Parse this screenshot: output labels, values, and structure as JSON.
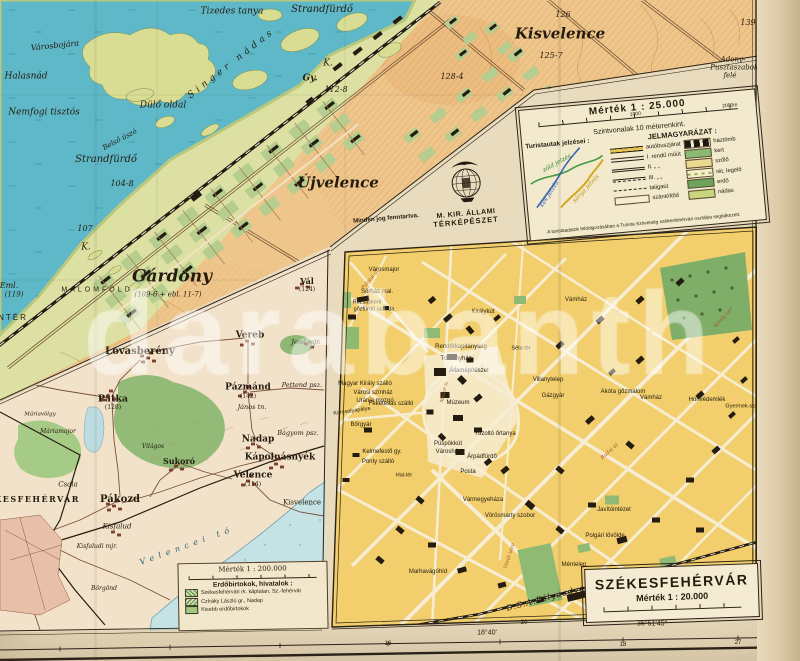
{
  "legend25": {
    "title": "Mérték 1 : 25.000",
    "scale_left": "1000",
    "scale_right": "2000m",
    "contours": "Szintvonalak 10 méterenkint.",
    "tourist_heading": "Turistautak jelzései :",
    "tourist_labels": [
      {
        "t": "zöld jelzés",
        "x": 30,
        "y": 16,
        "fs": 6,
        "st": "si",
        "rot": -24,
        "c": "#2e8b3a"
      },
      {
        "t": "kék jelzés",
        "x": 20,
        "y": 46,
        "fs": 6,
        "st": "si",
        "rot": -52,
        "c": "#2b5fae"
      },
      {
        "t": "sárga jelzés",
        "x": 57,
        "y": 44,
        "fs": 6,
        "st": "si",
        "rot": -42,
        "c": "#b8931c"
      }
    ],
    "key_heading": "JELMAGYARÁZAT :",
    "routes": [
      {
        "label": "autóbuszjárat",
        "swatch": "bus"
      },
      {
        "label": "I. rendű műút",
        "swatch": "road1"
      },
      {
        "label": "II.  „    „",
        "swatch": "road2"
      },
      {
        "label": "III.  „    „",
        "swatch": "road3"
      },
      {
        "label": "taligaút",
        "swatch": "cart"
      },
      {
        "label": "szántóföld",
        "swatch": "field"
      }
    ],
    "areas": [
      {
        "label": "háztömb",
        "swatch": "block"
      },
      {
        "label": "kert",
        "swatch": "garden"
      },
      {
        "label": "szőlő",
        "swatch": "vineyard"
      },
      {
        "label": "rét, legelő",
        "swatch": "meadow"
      },
      {
        "label": "erdő",
        "swatch": "forest"
      },
      {
        "label": "nádas",
        "swatch": "reed"
      }
    ],
    "rights": "Minden jog fenntartva.",
    "logo_line1": "M. KIR. ÁLLAMI",
    "logo_line2": "TÉRKÉPÉSZET",
    "credit": "A turistaadatok feldolgozásában a Turista Szövetség székesfehérvári osztálya segédkezett."
  },
  "title20": {
    "title": "SZÉKESFEHÉRVÁR",
    "scale": "Mérték 1 : 20.000"
  },
  "legend200": {
    "scale": "Mérték 1 : 200.000",
    "heading": "Erdőbirtokok, hivatalok :",
    "items": [
      {
        "label": "Székesfehérvári rk. káptalan, Sz.-fehérvár",
        "swatch": "hatch1"
      },
      {
        "label": "Czíráky László gr., Nadap",
        "swatch": "hatch2"
      },
      {
        "label": "Kisebb erdőbirtokok",
        "swatch": "green"
      }
    ]
  },
  "watermark": {
    "text": "darabanth"
  },
  "lake_map": {
    "labels": [
      {
        "t": "Városbojára",
        "x": 55,
        "y": 46,
        "fs": 8,
        "st": "si",
        "rot": -6
      },
      {
        "t": "Halasnád",
        "x": 26,
        "y": 77,
        "fs": 9,
        "st": "si"
      },
      {
        "t": "Nemfogi tisztós",
        "x": 44,
        "y": 113,
        "fs": 9,
        "st": "si"
      },
      {
        "t": "Tizedes tanya",
        "x": 232,
        "y": 12,
        "fs": 9,
        "st": "si"
      },
      {
        "t": "Strandfürdő",
        "x": 322,
        "y": 10,
        "fs": 10,
        "st": "si"
      },
      {
        "t": "Strandfürdő",
        "x": 106,
        "y": 160,
        "fs": 10,
        "st": "si"
      },
      {
        "t": "Singer nádas",
        "x": 232,
        "y": 64,
        "fs": 9,
        "st": "si",
        "rot": -38,
        "ls": 4
      },
      {
        "t": "Dülő oldal",
        "x": 163,
        "y": 106,
        "fs": 9,
        "st": "si"
      },
      {
        "t": "Belső úszó",
        "x": 120,
        "y": 140,
        "fs": 7,
        "st": "si",
        "rot": -28
      },
      {
        "t": "Újvelence",
        "x": 338,
        "y": 183,
        "fs": 15,
        "st": "sbi"
      },
      {
        "t": "Kisvelence",
        "x": 560,
        "y": 34,
        "fs": 15,
        "st": "sbi"
      },
      {
        "t": "126",
        "x": 563,
        "y": 15,
        "fs": 8,
        "st": "si"
      },
      {
        "t": "125-7",
        "x": 551,
        "y": 56,
        "fs": 8,
        "st": "si"
      },
      {
        "t": "128-4",
        "x": 452,
        "y": 77,
        "fs": 8,
        "st": "si"
      },
      {
        "t": "112-8",
        "x": 336,
        "y": 90,
        "fs": 8,
        "st": "si"
      },
      {
        "t": "Gy.",
        "x": 310,
        "y": 79,
        "fs": 9,
        "st": "sbi"
      },
      {
        "t": "K.",
        "x": 328,
        "y": 64,
        "fs": 9,
        "st": "si"
      },
      {
        "t": "K.",
        "x": 86,
        "y": 248,
        "fs": 9,
        "st": "si"
      },
      {
        "t": "107",
        "x": 85,
        "y": 229,
        "fs": 8,
        "st": "si"
      },
      {
        "t": "104-8",
        "x": 122,
        "y": 184,
        "fs": 8,
        "st": "si"
      },
      {
        "t": "Gárdony",
        "x": 172,
        "y": 277,
        "fs": 17,
        "st": "sbi"
      },
      {
        "t": "(109-6 + ebl. 11-7)",
        "x": 168,
        "y": 295,
        "fs": 7,
        "st": "si"
      },
      {
        "t": "MALOMFÖLD",
        "x": 97,
        "y": 290,
        "fs": 7,
        "st": "s",
        "ls": 3
      },
      {
        "t": "Adony-",
        "x": 733,
        "y": 60,
        "fs": 7,
        "st": "si"
      },
      {
        "t": "Pusztaszabolcs",
        "x": 737,
        "y": 68,
        "fs": 7,
        "st": "si"
      },
      {
        "t": "felé",
        "x": 730,
        "y": 76,
        "fs": 7,
        "st": "si"
      },
      {
        "t": "NTÉR",
        "x": 13,
        "y": 318,
        "fs": 8,
        "st": "s",
        "ls": 2
      },
      {
        "t": "Eml.",
        "x": 9,
        "y": 286,
        "fs": 8,
        "st": "si"
      },
      {
        "t": "(119)",
        "x": 14,
        "y": 295,
        "fs": 7,
        "st": "si"
      },
      {
        "t": "139",
        "x": 748,
        "y": 23,
        "fs": 8,
        "st": "si"
      }
    ]
  },
  "city_map": {
    "labels": [
      {
        "t": "Városmajor",
        "x": 384,
        "y": 270
      },
      {
        "t": "Sörház mal.",
        "x": 377,
        "y": 292
      },
      {
        "t": "Rózsáskerti",
        "x": 367,
        "y": 303,
        "fs": 5.5
      },
      {
        "t": "gőzfürdő uszoda",
        "x": 374,
        "y": 310,
        "fs": 5.5
      },
      {
        "t": "Királykút",
        "x": 483,
        "y": 312
      },
      {
        "t": "Rendőrkapitányság",
        "x": 461,
        "y": 347
      },
      {
        "t": "Törvényház",
        "x": 456,
        "y": 359
      },
      {
        "t": "Államépítészet",
        "x": 469,
        "y": 371
      },
      {
        "t": "Magyar Király szálló",
        "x": 365,
        "y": 384
      },
      {
        "t": "Városi színház",
        "x": 373,
        "y": 393
      },
      {
        "t": "Uránia mozgó",
        "x": 375,
        "y": 401
      },
      {
        "t": "Feketesas szálló",
        "x": 391,
        "y": 404
      },
      {
        "t": "Múzeum",
        "x": 458,
        "y": 403
      },
      {
        "t": "Bőrgyár",
        "x": 361,
        "y": 425
      },
      {
        "t": "Korcsolyapálya",
        "x": 352,
        "y": 412,
        "fs": 5.5,
        "rot": -8
      },
      {
        "t": "Kelmefestő gy.",
        "x": 382,
        "y": 452
      },
      {
        "t": "Ponty szálló",
        "x": 378,
        "y": 462
      },
      {
        "t": "Püspökkút",
        "x": 448,
        "y": 444
      },
      {
        "t": "Városháza",
        "x": 450,
        "y": 452
      },
      {
        "t": "Árpádfürdő",
        "x": 482,
        "y": 457
      },
      {
        "t": "Tűzoltó őrtanya",
        "x": 495,
        "y": 434
      },
      {
        "t": "Posta",
        "x": 468,
        "y": 472
      },
      {
        "t": "Hal-tér",
        "x": 404,
        "y": 476,
        "fs": 5.5
      },
      {
        "t": "Vármegyeháza",
        "x": 483,
        "y": 500
      },
      {
        "t": "Vörösmarty szobor",
        "x": 510,
        "y": 516
      },
      {
        "t": "Séta tér",
        "x": 521,
        "y": 349,
        "fs": 5.5
      },
      {
        "t": "Vámház",
        "x": 576,
        "y": 300
      },
      {
        "t": "Vámház",
        "x": 651,
        "y": 398
      },
      {
        "t": "Akóta gőzmalom",
        "x": 623,
        "y": 392
      },
      {
        "t": "Honvédemlék",
        "x": 707,
        "y": 400
      },
      {
        "t": "Gyermek-szan.",
        "x": 744,
        "y": 407,
        "fs": 5.5
      },
      {
        "t": "Villanytelep",
        "x": 548,
        "y": 380
      },
      {
        "t": "Gázgyár",
        "x": 553,
        "y": 396
      },
      {
        "t": "Javítóintézet",
        "x": 614,
        "y": 510
      },
      {
        "t": "Polgári lövölde",
        "x": 605,
        "y": 536
      },
      {
        "t": "Méntelep",
        "x": 574,
        "y": 565
      },
      {
        "t": "Marhavágóhíd",
        "x": 428,
        "y": 572
      },
      {
        "t": "D.S.A.Pályaudvar",
        "x": 548,
        "y": 598,
        "st": "si",
        "fs": 8,
        "rot": -15,
        "ls": 1
      },
      {
        "t": "Felekola",
        "x": 598,
        "y": 612,
        "fs": 5.5
      },
      {
        "t": "Palotai út",
        "x": 371,
        "y": 280,
        "st": "si",
        "fs": 5,
        "rot": -50,
        "c": "#a5502c"
      },
      {
        "t": "Budai út",
        "x": 610,
        "y": 452,
        "st": "si",
        "fs": 5,
        "rot": -42,
        "c": "#a5502c"
      },
      {
        "t": "Király sor",
        "x": 724,
        "y": 318,
        "st": "si",
        "fs": 5,
        "rot": -48,
        "c": "#a5502c"
      },
      {
        "t": "Vasút utca",
        "x": 510,
        "y": 556,
        "st": "si",
        "fs": 5,
        "rot": -72,
        "c": "#a5502c"
      },
      {
        "t": "Nádor u.",
        "x": 445,
        "y": 392,
        "st": "si",
        "fs": 5,
        "rot": -78,
        "c": "#a5502c"
      }
    ]
  },
  "overview_map": {
    "labels": [
      {
        "t": "Lovasberény",
        "x": 140,
        "y": 352,
        "st": "srb",
        "fs": 10
      },
      {
        "t": "Vereb",
        "x": 250,
        "y": 336,
        "st": "srb",
        "fs": 9
      },
      {
        "t": "Pázmánd",
        "x": 248,
        "y": 388,
        "st": "srb",
        "fs": 9
      },
      {
        "t": "(142)",
        "x": 248,
        "y": 397,
        "st": "sr",
        "fs": 6
      },
      {
        "t": "János tn.",
        "x": 252,
        "y": 407,
        "st": "si",
        "fs": 6.5
      },
      {
        "t": "Pettend psz.",
        "x": 302,
        "y": 385,
        "st": "si",
        "fs": 6.5
      },
      {
        "t": "Bágyom psz.",
        "x": 298,
        "y": 433,
        "st": "si",
        "fs": 6.5
      },
      {
        "t": "Nadap",
        "x": 258,
        "y": 440,
        "st": "srb",
        "fs": 9
      },
      {
        "t": "Kápolnásnyék",
        "x": 280,
        "y": 458,
        "st": "srb",
        "fs": 9
      },
      {
        "t": "Velence",
        "x": 253,
        "y": 476,
        "st": "srb",
        "fs": 9
      },
      {
        "t": "(114)",
        "x": 253,
        "y": 485,
        "st": "sr",
        "fs": 6
      },
      {
        "t": "Kisvelence",
        "x": 302,
        "y": 503,
        "st": "sr",
        "fs": 7
      },
      {
        "t": "Sukoró",
        "x": 179,
        "y": 461,
        "st": "srb",
        "fs": 8
      },
      {
        "t": "Pátka",
        "x": 113,
        "y": 399,
        "st": "srb",
        "fs": 9.5
      },
      {
        "t": "(128)",
        "x": 113,
        "y": 408,
        "st": "sr",
        "fs": 6
      },
      {
        "t": "Máriamajor",
        "x": 58,
        "y": 432,
        "st": "si",
        "fs": 6
      },
      {
        "t": "Világos",
        "x": 153,
        "y": 447,
        "st": "si",
        "fs": 6
      },
      {
        "t": "Csala",
        "x": 68,
        "y": 485,
        "st": "si",
        "fs": 7
      },
      {
        "t": "Pákozd",
        "x": 120,
        "y": 500,
        "st": "srb",
        "fs": 10
      },
      {
        "t": "SZÉKESFEHÉRVÁR",
        "x": 26,
        "y": 499,
        "st": "srb",
        "fs": 8,
        "ls": 1.5
      },
      {
        "t": "Kisfalud",
        "x": 117,
        "y": 527,
        "st": "si",
        "fs": 7
      },
      {
        "t": "Kisfaludi mjr.",
        "x": 97,
        "y": 547,
        "st": "si",
        "fs": 6
      },
      {
        "t": "Börgönd",
        "x": 104,
        "y": 589,
        "st": "si",
        "fs": 6
      },
      {
        "t": "Velencei tó",
        "x": 187,
        "y": 546,
        "st": "si",
        "fs": 8,
        "ls": 5,
        "rot": -20,
        "c": "#2f6575"
      },
      {
        "t": "Jenő mjr.",
        "x": 306,
        "y": 342,
        "st": "si",
        "fs": 6.5
      },
      {
        "t": "Vál",
        "x": 307,
        "y": 281,
        "st": "srb",
        "fs": 8
      },
      {
        "t": "(124)",
        "x": 307,
        "y": 290,
        "st": "sr",
        "fs": 6
      },
      {
        "t": "Máriavölgy",
        "x": 40,
        "y": 415,
        "st": "si",
        "fs": 5.5
      }
    ]
  },
  "margin": {
    "labels": [
      {
        "t": "18°40'",
        "x": 487,
        "y": 633,
        "fs": 7,
        "st": "s"
      },
      {
        "t": "36°51'45″",
        "x": 652,
        "y": 624,
        "fs": 7,
        "st": "s"
      },
      {
        "t": "47°52'",
        "x": 776,
        "y": 616,
        "fs": 6,
        "st": "s"
      },
      {
        "t": "20",
        "x": 524,
        "y": 623,
        "fs": 6,
        "st": "s"
      },
      {
        "t": "16",
        "x": 388,
        "y": 644,
        "fs": 6,
        "st": "s"
      },
      {
        "t": "18",
        "x": 623,
        "y": 645,
        "fs": 6,
        "st": "s"
      },
      {
        "t": "27",
        "x": 738,
        "y": 643,
        "fs": 6,
        "st": "s"
      },
      {
        "t": "Velence ék. Kápolnásnyék",
        "x": 764,
        "y": 80,
        "fs": 5.5,
        "st": "s",
        "rot": -90,
        "c": "#7a6950"
      },
      {
        "t": "15",
        "x": 789,
        "y": 12,
        "fs": 8,
        "st": "s",
        "c": "#9a8a6a"
      }
    ]
  }
}
